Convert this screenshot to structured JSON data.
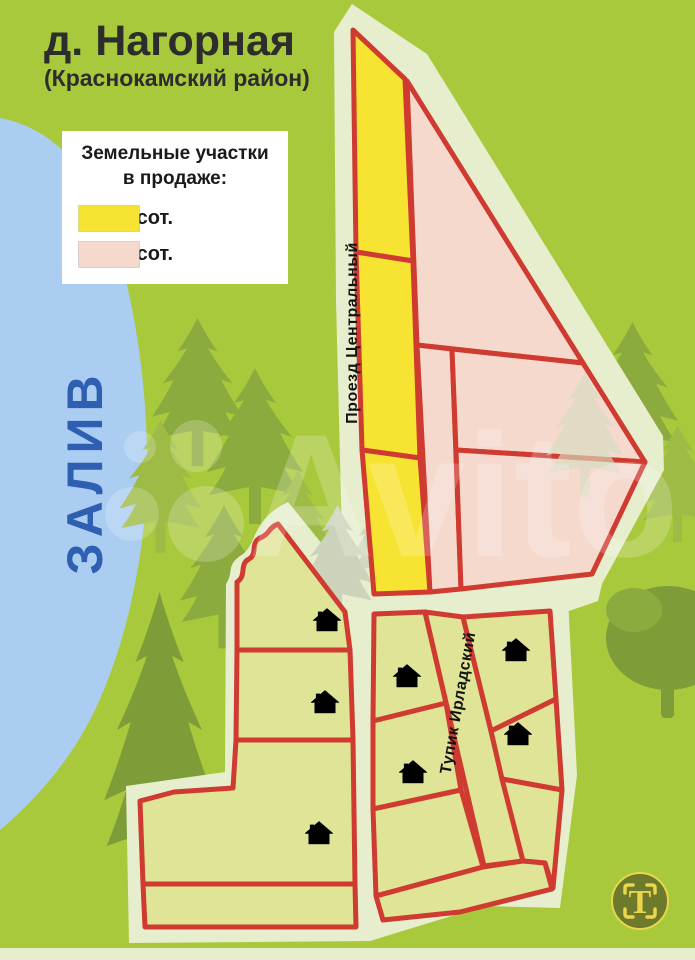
{
  "page": {
    "title": "д. Нагорная",
    "subtitle": "(Краснокамский район)"
  },
  "legend": {
    "title_line1": "Земельные участки",
    "title_line2": "в продаже:",
    "items": [
      {
        "label": "- 6,3 сот.",
        "color": "#f7e331"
      },
      {
        "label": "- 9,3 сот.",
        "color": "#f6d9cd"
      }
    ]
  },
  "map": {
    "bay_label": "ЗАЛИВ",
    "road_central_label": "Проезд Центральный",
    "road_deadend_label": "Тупик Ирладский",
    "house_count": 7
  },
  "watermark": {
    "brand": "Avito",
    "logo_letter": "T"
  },
  "colors": {
    "background_green": "#a9c93c",
    "bay_blue": "#abcdf1",
    "bay_text_blue": "#2e5fb0",
    "outline_cream": "#e7eecd",
    "parcel_yellow": "#f7e331",
    "parcel_pink": "#f6d9cd",
    "parcel_khaki": "#dfe497",
    "border_red": "#cf3b30",
    "tree_green": "#8cab3e",
    "label_black": "#141414",
    "logo_olive": "#6d7a2b",
    "logo_yellow": "#e9d64b"
  }
}
